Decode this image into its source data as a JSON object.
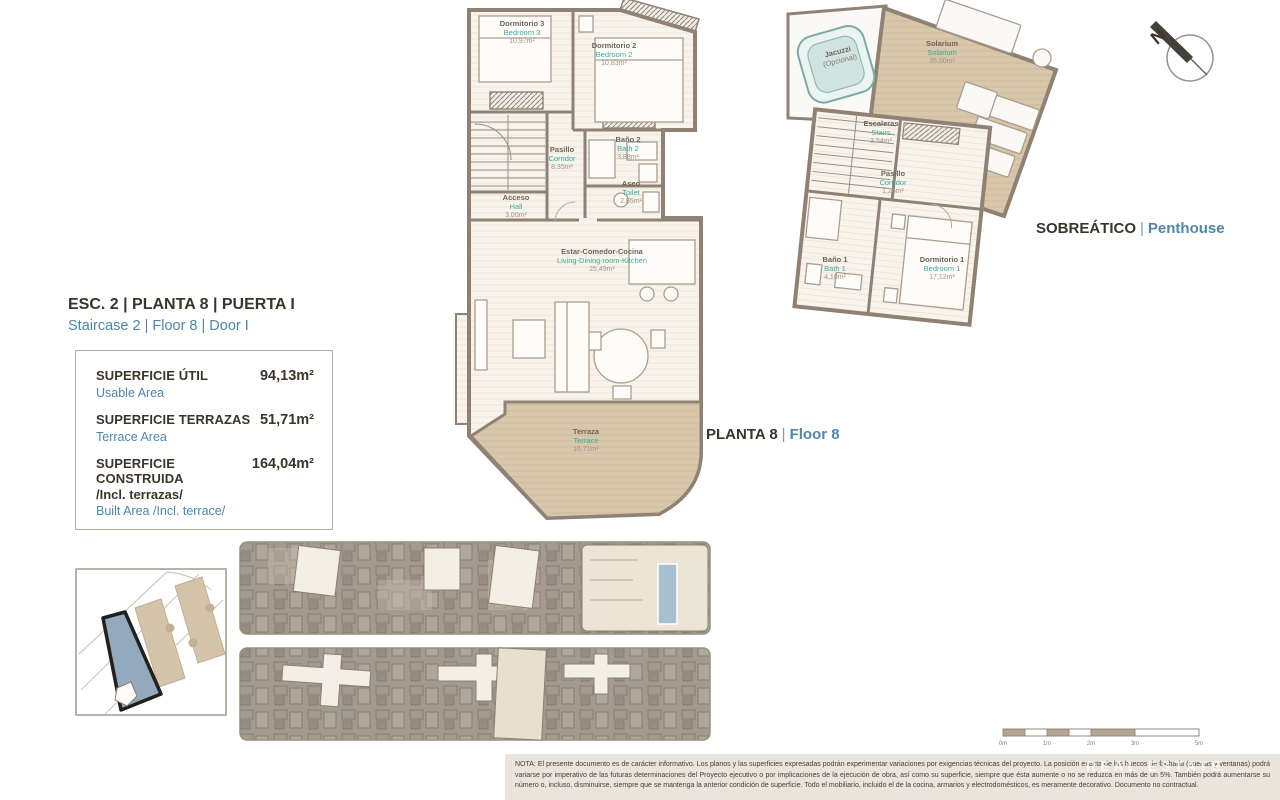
{
  "unit_header": {
    "title_es": "ESC. 2 | PLANTA 8 | PUERTA I",
    "title_en": "Staircase 2 | Floor 8 | Door I"
  },
  "areas_box": {
    "rows": [
      {
        "label_es": "SUPERFICIE ÚTIL",
        "label_en": "Usable Area",
        "value": "94,13m²"
      },
      {
        "label_es": "SUPERFICIE TERRAZAS",
        "label_en": "Terrace Area",
        "value": "51,71m²"
      },
      {
        "label_es": "SUPERFICIE CONSTRUIDA",
        "label_es_extra": "/Incl. terrazas/",
        "label_en": "Built Area /Incl. terrace/",
        "value": "164,04m²"
      }
    ]
  },
  "floor8": {
    "caption_es": "PLANTA 8",
    "caption_en": "Floor 8",
    "sep": "|",
    "rooms": [
      {
        "name_es": "Dormitorio 3",
        "name_en": "Bedroom 3",
        "area": "10,97m²"
      },
      {
        "name_es": "Dormitorio 2",
        "name_en": "Bedroom 2",
        "area": "10,83m²"
      },
      {
        "name_es": "Baño 2",
        "name_en": "Bath 2",
        "area": "3,88m²"
      },
      {
        "name_es": "Pasillo",
        "name_en": "Corridor",
        "area": "8,35m²"
      },
      {
        "name_es": "Aseo",
        "name_en": "Toilet",
        "area": "2,85m²"
      },
      {
        "name_es": "Acceso",
        "name_en": "Hall",
        "area": "3,00m²"
      },
      {
        "name_es": "Estar-Comedor-Cocina",
        "name_en": "Living-Dining room-Kitchen",
        "area": "25,49m²"
      },
      {
        "name_es": "Terraza",
        "name_en": "Terrace",
        "area": "16,71m²"
      }
    ]
  },
  "penthouse": {
    "caption_es": "SOBREÁTICO",
    "caption_en": "Penthouse",
    "sep": "|",
    "rooms": [
      {
        "name_es": "Jacuzzi",
        "name_en": "(Opcional)",
        "area": ""
      },
      {
        "name_es": "Solarium",
        "name_en": "Solarium",
        "area": "35,00m²"
      },
      {
        "name_es": "Escaleras",
        "name_en": "Stairs",
        "area": "3,54m²"
      },
      {
        "name_es": "Pasillo",
        "name_en": "Corridor",
        "area": "1,26m²"
      },
      {
        "name_es": "Baño 1",
        "name_en": "Bath 1",
        "area": "4,10m²"
      },
      {
        "name_es": "Dormitorio 1",
        "name_en": "Bedroom 1",
        "area": "17,12m²"
      }
    ]
  },
  "compass": {
    "north_label": "N"
  },
  "scale_bar": {
    "labels": [
      "0m",
      "1m",
      "2m",
      "3m",
      "5m"
    ]
  },
  "watermark": "REAL ESTATE",
  "disclaimer": {
    "note_es": "NOTA: El presente documento es de carácter informativo. Los planos y las superficies expresadas podrán experimentar variaciones por exigencias técnicas del proyecto. La posición exacta de los huecos de fachada (puertas y ventanas) podrá variarse por imperativo de las futuras determinaciones del Proyecto ejecutivo o por implicaciones de la ejecución de obra, así como su superficie, siempre que ésta aumente o no se reduzca en más de un 5%. También podrá aumentarse su número o, incluso, disminuirse, siempre que se mantenga la anterior condición de superficie. Todo el mobiliario, incluido el de la cocina, armarios y electrodomésticos, es meramente decorativo. Documento no contractual.",
    "note_en": "Note: This plan is provisional and subject to any changes that may arise from licensing requirements or site management criteria, without compromising quality. The furniture and household items that appear in the plan are merely decorative."
  },
  "colors": {
    "accent_blue": "#4e86ac",
    "accent_teal": "#3fa9a1",
    "terrace_beige": "#d7c6aa",
    "highlight_blue": "#92a9be"
  }
}
